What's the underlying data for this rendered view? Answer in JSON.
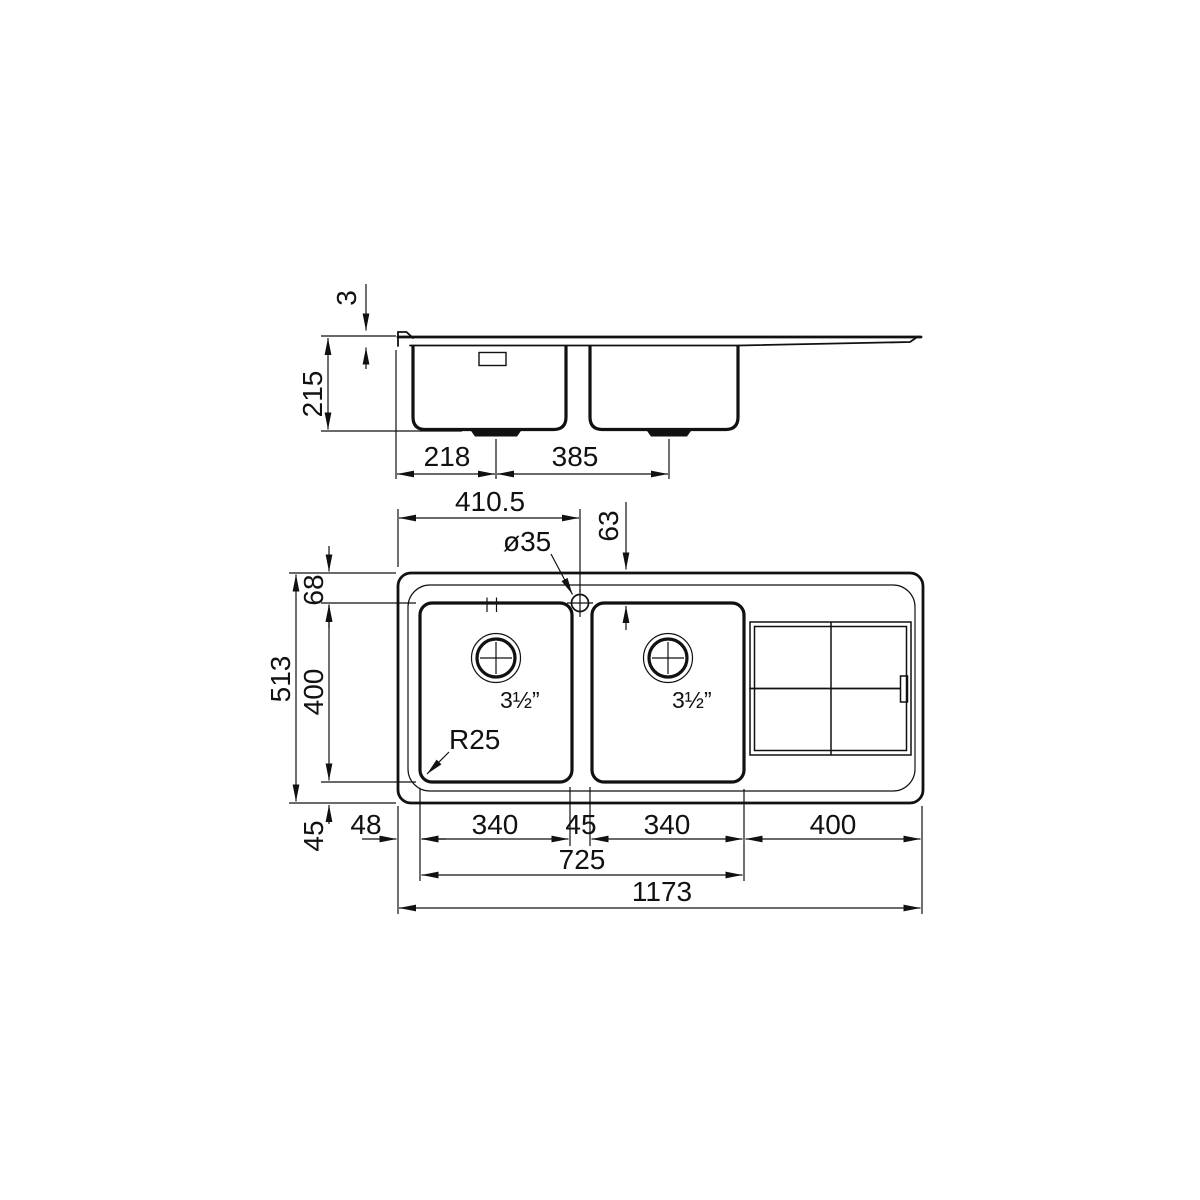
{
  "drawing_title": "Double bowl sink with drainer - dimensioned technical drawing",
  "side_view": {
    "rim_thickness": "3",
    "bowl_depth": "215",
    "drain1_from_left": "218",
    "drain_spacing": "385"
  },
  "plan_view": {
    "tap_from_left": "410.5",
    "tap_hole_diameter": "ø35",
    "tap_to_bowl_edge": "63",
    "rim_to_bowl_top": "68",
    "overall_depth": "513",
    "bowl_inner_depth": "400",
    "bowl_to_front_rim": "45",
    "rim_to_bowl1": "48",
    "bowl1_width": "340",
    "bowl_gap": "45",
    "bowl2_width": "340",
    "drainer_width": "400",
    "bowls_span": "725",
    "overall_width": "1173",
    "corner_radius": "R25",
    "bowl1_waste": "3½”",
    "bowl2_waste": "3½”"
  },
  "colors": {
    "line": "#111111",
    "background": "#ffffff"
  }
}
